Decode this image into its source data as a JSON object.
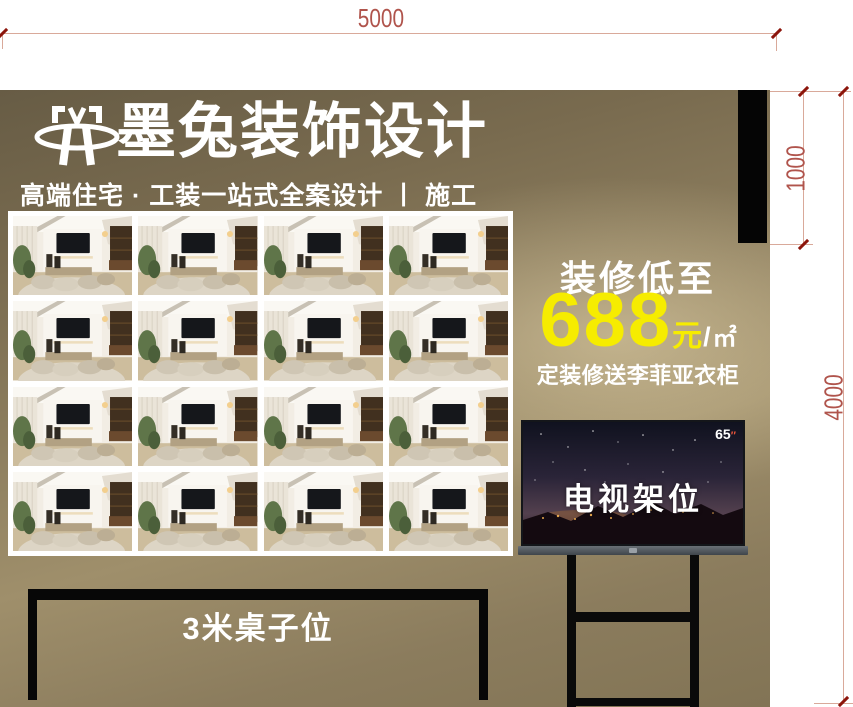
{
  "dims": {
    "width": "5000",
    "header_height": "1000",
    "total_height": "4000"
  },
  "banner": {
    "title": "墨兔装饰设计",
    "subtitle": "高端住宅 · 工装一站式全案设计 丨 施工",
    "promo": {
      "heading": "装修低至",
      "price": "688",
      "unit_currency": "元",
      "unit_slash": "/",
      "unit_area": "㎡",
      "gift_line": "定装修送李菲亚衣柜"
    },
    "tv": {
      "size": "65",
      "size_mark": "″",
      "label": "电视架位"
    },
    "table": {
      "label": "3米桌子位"
    },
    "gallery": {
      "count": 16,
      "photo_name": "living-room-interior-photo"
    }
  },
  "colors": {
    "accent_yellow": "#f6ec00",
    "dimension_text": "#b0544c",
    "dimension_tick": "#8c150b",
    "dimension_line": "#d9a99a",
    "panel_dark": "#675c45",
    "panel_light": "#c3b38b",
    "header_bar": "#050505"
  }
}
